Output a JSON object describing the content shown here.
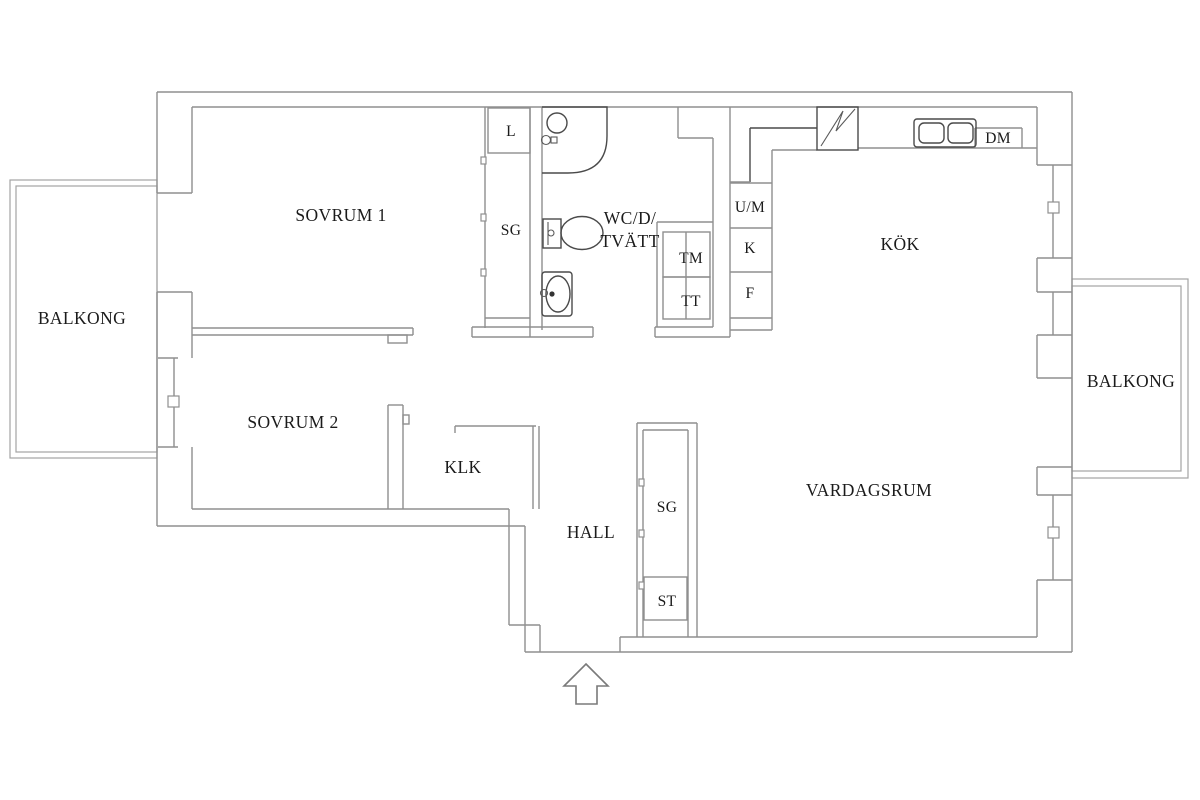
{
  "floorplan": {
    "type": "apartment-floor-plan",
    "labels": {
      "balkong_left": "BALKONG",
      "sovrum1": "SOVRUM 1",
      "l_closet": "L",
      "sg_top": "SG",
      "wc_line1": "WC/D/",
      "wc_line2": "TVÄTT",
      "tm": "TM",
      "tt": "TT",
      "um": "U/M",
      "k": "K",
      "f": "F",
      "kok": "KÖK",
      "dm": "DM",
      "vardagsrum": "VARDAGSRUM",
      "balkong_right": "BALKONG",
      "sovrum2": "SOVRUM 2",
      "klk": "KLK",
      "hall": "HALL",
      "sg_hall": "SG",
      "st": "ST"
    },
    "colors": {
      "background": "#ffffff",
      "wall": "#8f8f8f",
      "wall_light": "#a3a3a3",
      "fixture": "#4a4a4a",
      "text": "#1b1b1b"
    }
  }
}
